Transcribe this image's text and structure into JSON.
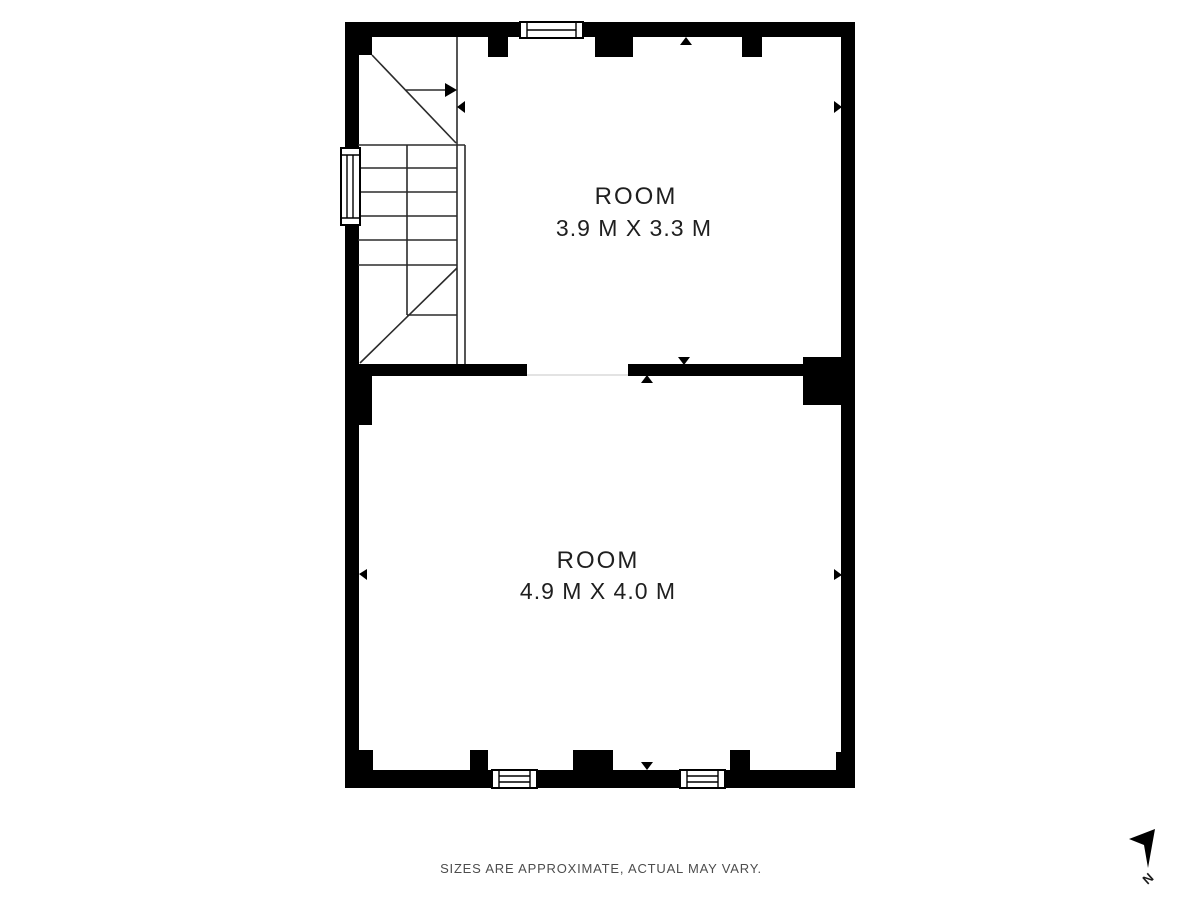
{
  "plan": {
    "rooms": [
      {
        "name": "ROOM",
        "dimensions": "3.9 M X 3.3 M"
      },
      {
        "name": "ROOM",
        "dimensions": "4.9 M X 4.0 M"
      }
    ],
    "disclaimer": "SIZES ARE APPROXIMATE, ACTUAL MAY VARY.",
    "compass": {
      "label": "N"
    },
    "colors": {
      "wall": "#000000",
      "background": "#ffffff",
      "line": "#2b2b2b",
      "label_text": "#1f1f1f",
      "disclaimer_text": "#4d4d4d"
    }
  }
}
